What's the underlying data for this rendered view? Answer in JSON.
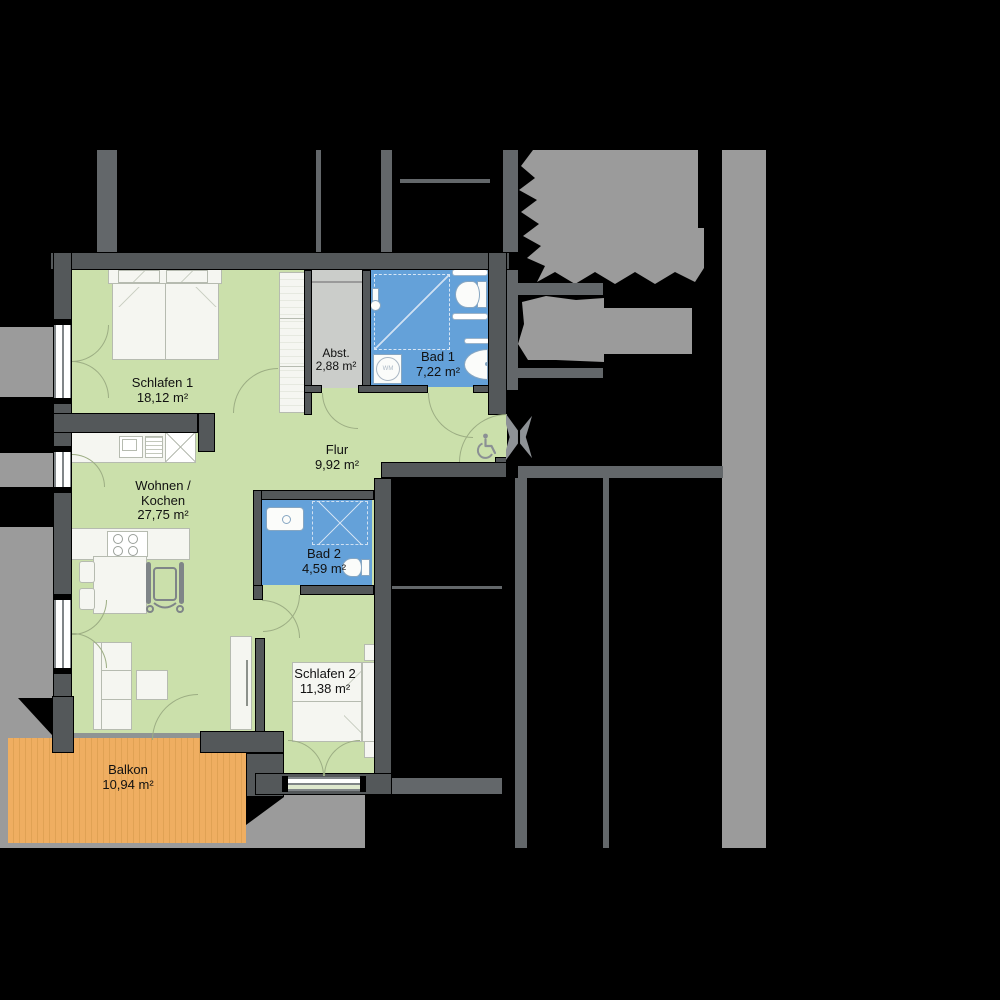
{
  "plan_title": "Barrier-free apartment floor plan",
  "rooms": {
    "schlafen1": {
      "name": "Schlafen 1",
      "area": "18,12 m²"
    },
    "abstellraum": {
      "name": "Abst.",
      "area": "2,88 m²"
    },
    "bad1": {
      "name": "Bad 1",
      "area": "7,22 m²"
    },
    "flur": {
      "name": "Flur",
      "area": "9,92 m²"
    },
    "wohnen_kochen": {
      "name1": "Wohnen /",
      "name2": "Kochen",
      "area": "27,75 m²"
    },
    "bad2": {
      "name": "Bad 2",
      "area": "4,59 m²"
    },
    "schlafen2": {
      "name": "Schlafen 2",
      "area": "11,38 m²"
    },
    "balkon": {
      "name": "Balkon",
      "area": "10,94 m²"
    }
  },
  "labels": {
    "washing_machine": "WM"
  },
  "icons": [
    "wheelchair-accessibility-icon",
    "wheelchair-at-table-icon",
    "entrance-door-icon",
    "washing-machine-icon",
    "toilet-icon",
    "washbasin-icon",
    "shower-icon",
    "stove-icon",
    "sink-icon"
  ],
  "colors": {
    "room_green": "#cbe0ab",
    "room_blue": "#64a1d9",
    "room_gray": "#cbcdca",
    "balcony_orange": "#efae61",
    "apartment_wall": "#54585a",
    "neighbor_wall": "#63676a",
    "exterior_gray": "#9b9b9b",
    "background": "#000000"
  }
}
